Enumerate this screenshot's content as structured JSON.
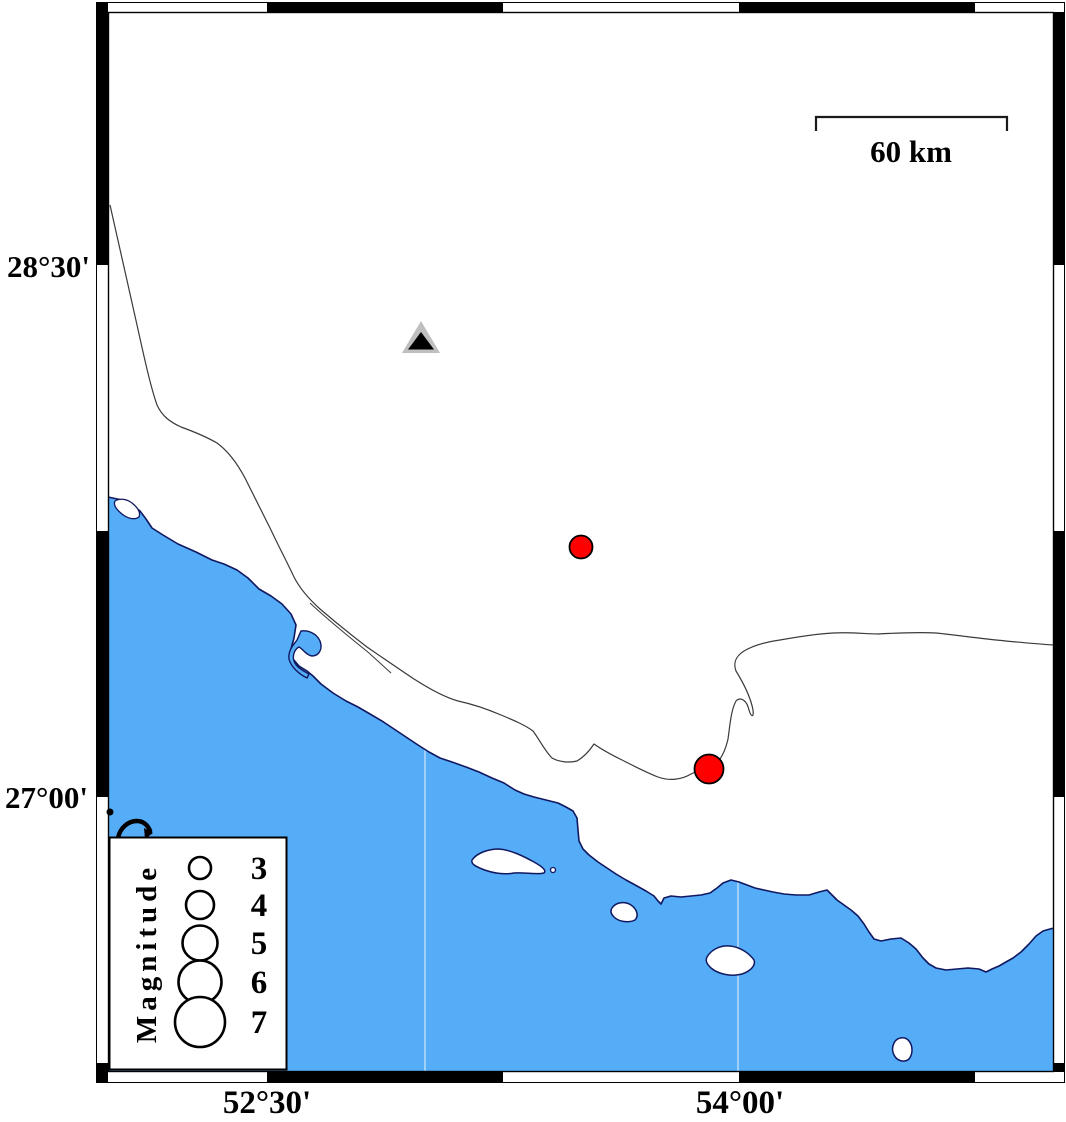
{
  "map_type": "seismicity-map",
  "colors": {
    "sea": "#55ACF7",
    "land": "#FFFFFF",
    "coast_outline": "#101860",
    "inland_line": "#3a3a3a",
    "frame_black": "#000000",
    "event_fill": "#FF0000",
    "event_outline": "#000000",
    "station_outer": "#BFBFBF",
    "station_inner": "#000000",
    "gridline": "rgba(255,255,255,0.55)"
  },
  "axis": {
    "left": [
      {
        "text": "28°30'"
      },
      {
        "text": "27°00'"
      }
    ],
    "bottom": [
      {
        "text": "52°30'"
      },
      {
        "text": "54°00'"
      }
    ]
  },
  "scale_bar": {
    "label": "60 km",
    "length_km": 60
  },
  "legend": {
    "title": "Magnitude",
    "entries": [
      {
        "magnitude": "3",
        "radius": 11,
        "y": 868
      },
      {
        "magnitude": "4",
        "radius": 14,
        "y": 905
      },
      {
        "magnitude": "5",
        "radius": 17.5,
        "y": 943
      },
      {
        "magnitude": "6",
        "radius": 21.5,
        "y": 982
      },
      {
        "magnitude": "7",
        "radius": 25,
        "y": 1022
      }
    ]
  },
  "markers": {
    "stations": [
      {
        "x": 421,
        "y": 339
      }
    ],
    "earthquakes": [
      {
        "x": 581,
        "y": 547,
        "radius": 11.5,
        "approx_magnitude": 3
      },
      {
        "x": 709,
        "y": 769,
        "radius": 14.5,
        "approx_magnitude": 4
      }
    ]
  },
  "gridlines": {
    "vertical_x": [
      425,
      738
    ]
  }
}
